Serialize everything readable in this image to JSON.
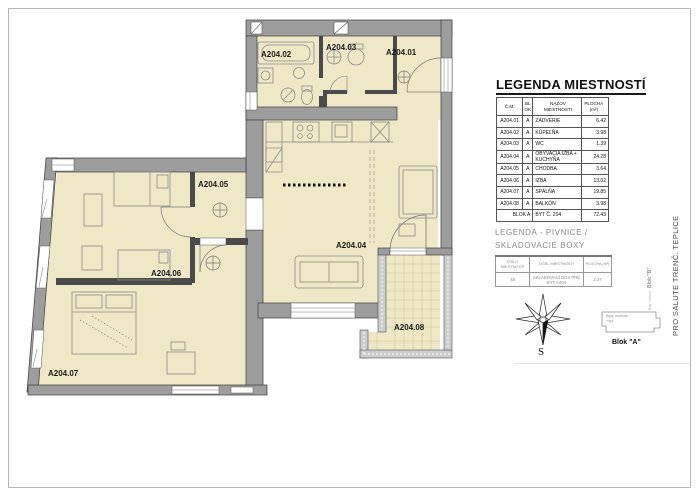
{
  "plan": {
    "labels": {
      "a01": "A204.01",
      "a02": "A204.02",
      "a03": "A204.03",
      "a04": "A204.04",
      "a05": "A204.05",
      "a06": "A204.06",
      "a07": "A204.07",
      "a08": "A204.08"
    },
    "colors": {
      "room_fill": "#efe8c6",
      "wall_fill": "#9d9d9d",
      "line": "#3d3d3d"
    }
  },
  "legend_rooms": {
    "title": "LEGENDA MIESTNOSTÍ",
    "headers": {
      "cm": "Č.M.",
      "blok": "BL OK",
      "name": "NÁZOV MIESTNOSTI",
      "area_line1": "PLOCHA",
      "area_line2": "(m²)"
    },
    "rows": [
      {
        "cm": "A204.01",
        "blok": "A",
        "name": "ZÁDVERIE",
        "area": "6.42"
      },
      {
        "cm": "A204.02",
        "blok": "A",
        "name": "KÚPEĽŇA",
        "area": "3.98"
      },
      {
        "cm": "A204.03",
        "blok": "A",
        "name": "WC",
        "area": "1.39"
      },
      {
        "cm": "A204.04",
        "blok": "A",
        "name": "OBÝVACIA IZBA + KUCHYŇA",
        "area": "24.28"
      },
      {
        "cm": "A204.05",
        "blok": "A",
        "name": "CHODBA",
        "area": "3.64"
      },
      {
        "cm": "A204.06",
        "blok": "A",
        "name": "IZBA",
        "area": "13.02"
      },
      {
        "cm": "A204.07",
        "blok": "A",
        "name": "SPÁLŇA",
        "area": "19.85"
      },
      {
        "cm": "A204.08",
        "blok": "A",
        "name": "BALKÓN",
        "area": "3.98"
      }
    ],
    "total": {
      "label": "BLOK A",
      "name": "BYT Č. 204",
      "area": "72.43"
    }
  },
  "legend_storage": {
    "title_line1": "LEGENDA - PIVNICE /",
    "title_line2": "SKLADOVACIE BOXY",
    "headers": {
      "num_line1": "ČÍSLO",
      "num_line2": "MIESTNOSTI",
      "purpose": "ÚČEL MIESTNOSTI",
      "area": "PLOCHA (m²)"
    },
    "row": {
      "num": "48",
      "purpose": "SKLADOVACÍ BOX PRE BYT A204",
      "area": "2.37"
    }
  },
  "compass": {
    "south_label": "S"
  },
  "site": {
    "block_a_note_line1": "Byty osobné",
    "block_a_note_line2": "+spl",
    "block_a_label": "Blok \"A\"",
    "block_b_note": "Byty osobné",
    "block_b_label": "Blok \"B\""
  },
  "footer": {
    "side_text": "PRO SALUTE TRENČ. TEPLICE"
  }
}
